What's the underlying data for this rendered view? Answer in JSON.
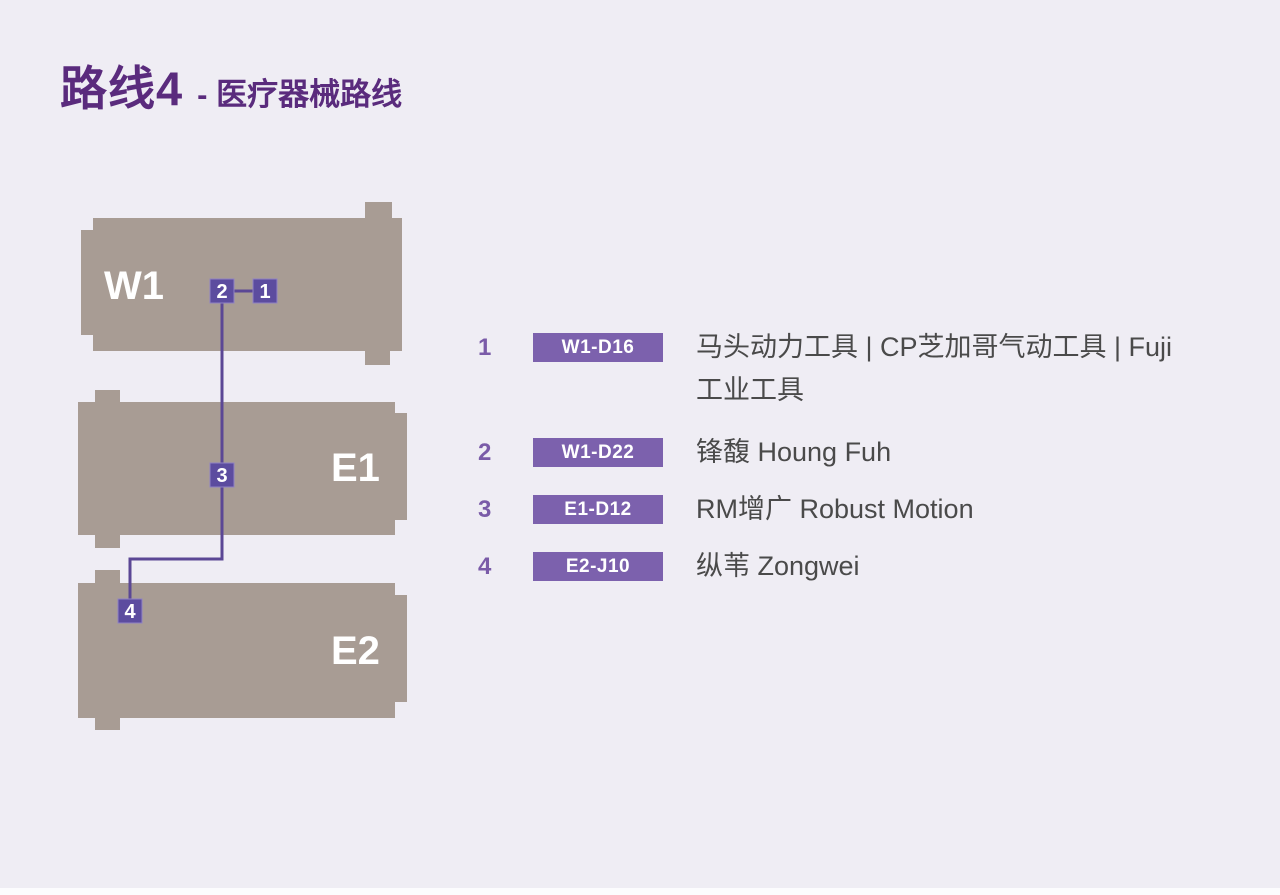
{
  "title": {
    "main": "路线4",
    "sub": "- 医疗器械路线"
  },
  "map": {
    "buildings": [
      {
        "label": "W1"
      },
      {
        "label": "E1"
      },
      {
        "label": "E2"
      }
    ],
    "markers": [
      {
        "label": "1"
      },
      {
        "label": "2"
      },
      {
        "label": "3"
      },
      {
        "label": "4"
      }
    ]
  },
  "legend": {
    "items": [
      {
        "num": "1",
        "booth": "W1-D16",
        "name": "马头动力工具 | CP芝加哥气动工具 | Fuji工业工具"
      },
      {
        "num": "2",
        "booth": "W1-D22",
        "name": "锋馥 Houng Fuh"
      },
      {
        "num": "3",
        "booth": "E1-D12",
        "name": "RM增广 Robust Motion"
      },
      {
        "num": "4",
        "booth": "E2-J10",
        "name": "纵苇 Zongwei"
      }
    ]
  },
  "colors": {
    "background": "#EFEDF4",
    "building": "#A89C94",
    "title_purple": "#5A2B7D",
    "marker_purple": "#5C4C9F",
    "badge_purple": "#7C61AD",
    "route_line": "#5B4795",
    "legend_number": "#7A5BA8",
    "legend_text": "#4A4A4A"
  }
}
